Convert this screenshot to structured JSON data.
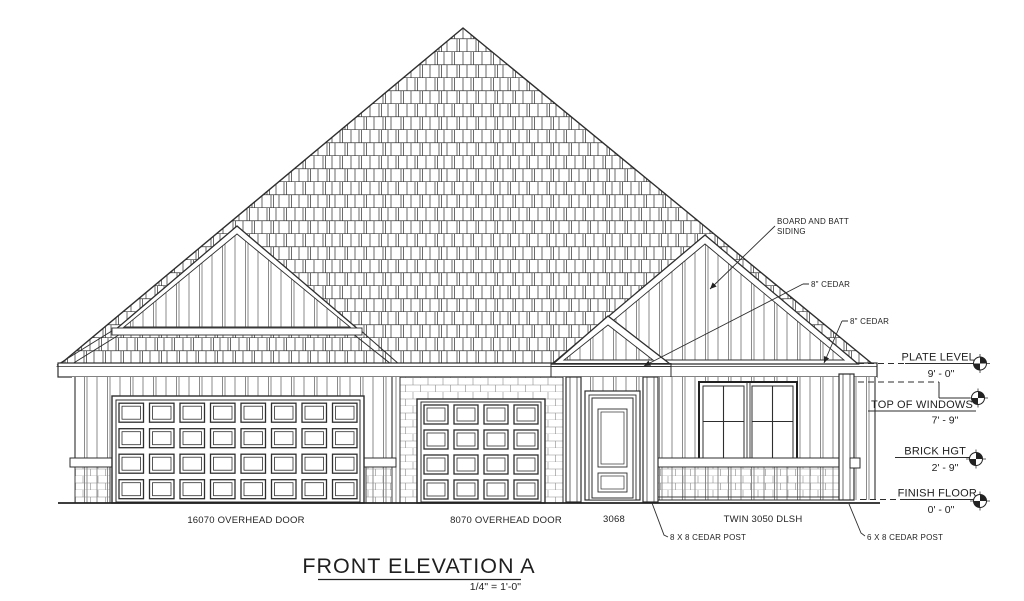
{
  "drawing": {
    "title": "FRONT ELEVATION A",
    "scale_label": "1/4\" = 1'-0\"",
    "line_color": "#2e2e2e",
    "background": "#ffffff",
    "callouts": {
      "board_batt_line1": "BOARD AND BATT",
      "board_batt_line2": "SIDING",
      "cedar_upper": "8\" CEDAR",
      "cedar_lower": "8\" CEDAR",
      "post_left": "8 X 8 CEDAR POST",
      "post_right": "6 X 8 CEDAR POST"
    },
    "levels": [
      {
        "name": "PLATE LEVEL",
        "value": "9' - 0\""
      },
      {
        "name": "TOP OF WINDOWS",
        "value": "7' - 9\""
      },
      {
        "name": "BRICK HGT",
        "value": "2' - 9\""
      },
      {
        "name": "FINISH FLOOR",
        "value": "0' - 0\""
      }
    ],
    "openings": [
      {
        "label": "16070 OVERHEAD DOOR"
      },
      {
        "label": "8070 OVERHEAD DOOR"
      },
      {
        "label": "3068"
      },
      {
        "label": "TWIN 3050 DLSH"
      }
    ]
  }
}
